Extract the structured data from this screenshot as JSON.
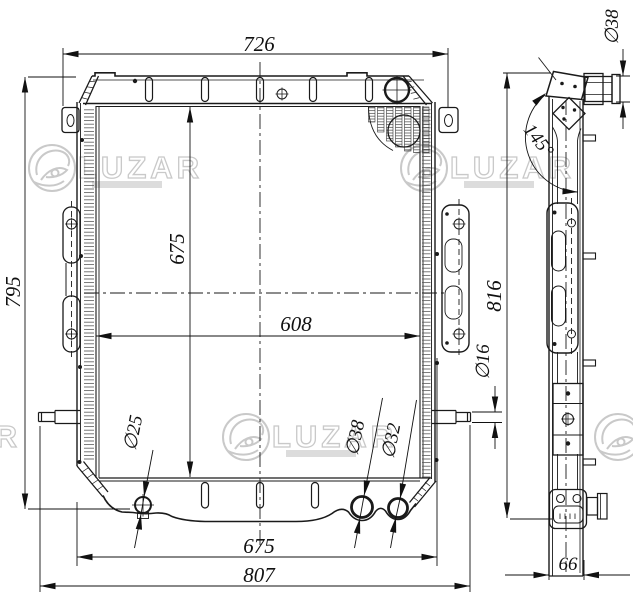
{
  "drawing": {
    "dimensions": {
      "top_width": "726",
      "overall_height_left": "795",
      "core_height": "675",
      "core_width": "608",
      "overall_height_right": "816",
      "mount_width": "675",
      "overall_width": "807",
      "depth": "66",
      "drain_plug_dia": "∅25",
      "outlet_left_dia": "∅38",
      "outlet_right_dia": "∅32",
      "boss_dia": "∅16",
      "top_pipe_dia": "∅38",
      "tank_angle": "145°"
    },
    "watermark": {
      "text": "LUZAR"
    }
  }
}
